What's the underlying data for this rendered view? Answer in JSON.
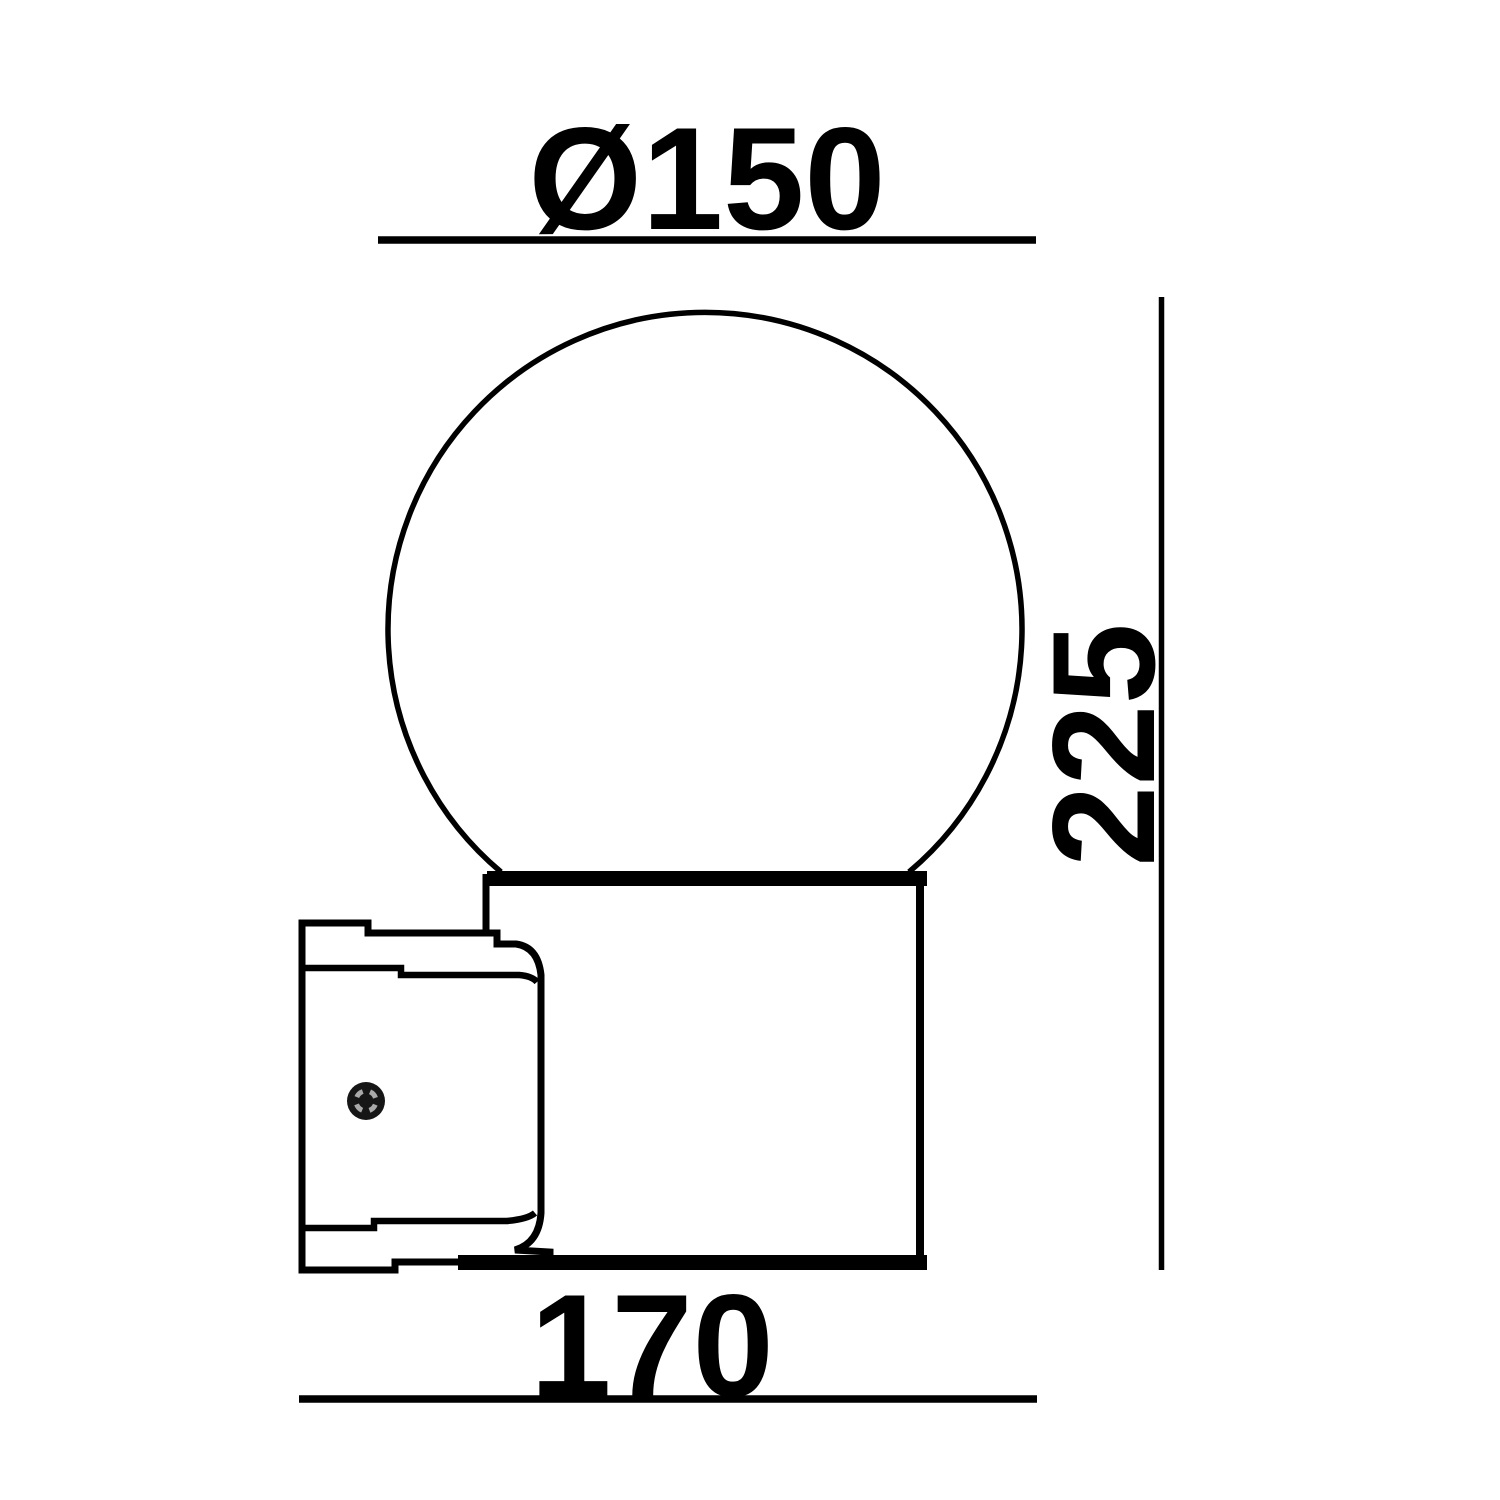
{
  "drawing": {
    "title": "wall-lamp-dimension-drawing",
    "dimensions": {
      "diameter": "Ø150",
      "height": "225",
      "depth": "170"
    },
    "colors": {
      "line": "#000000",
      "background": "#ffffff",
      "screw_fill": "#161616",
      "screw_detail": "#a9a9a9"
    }
  }
}
